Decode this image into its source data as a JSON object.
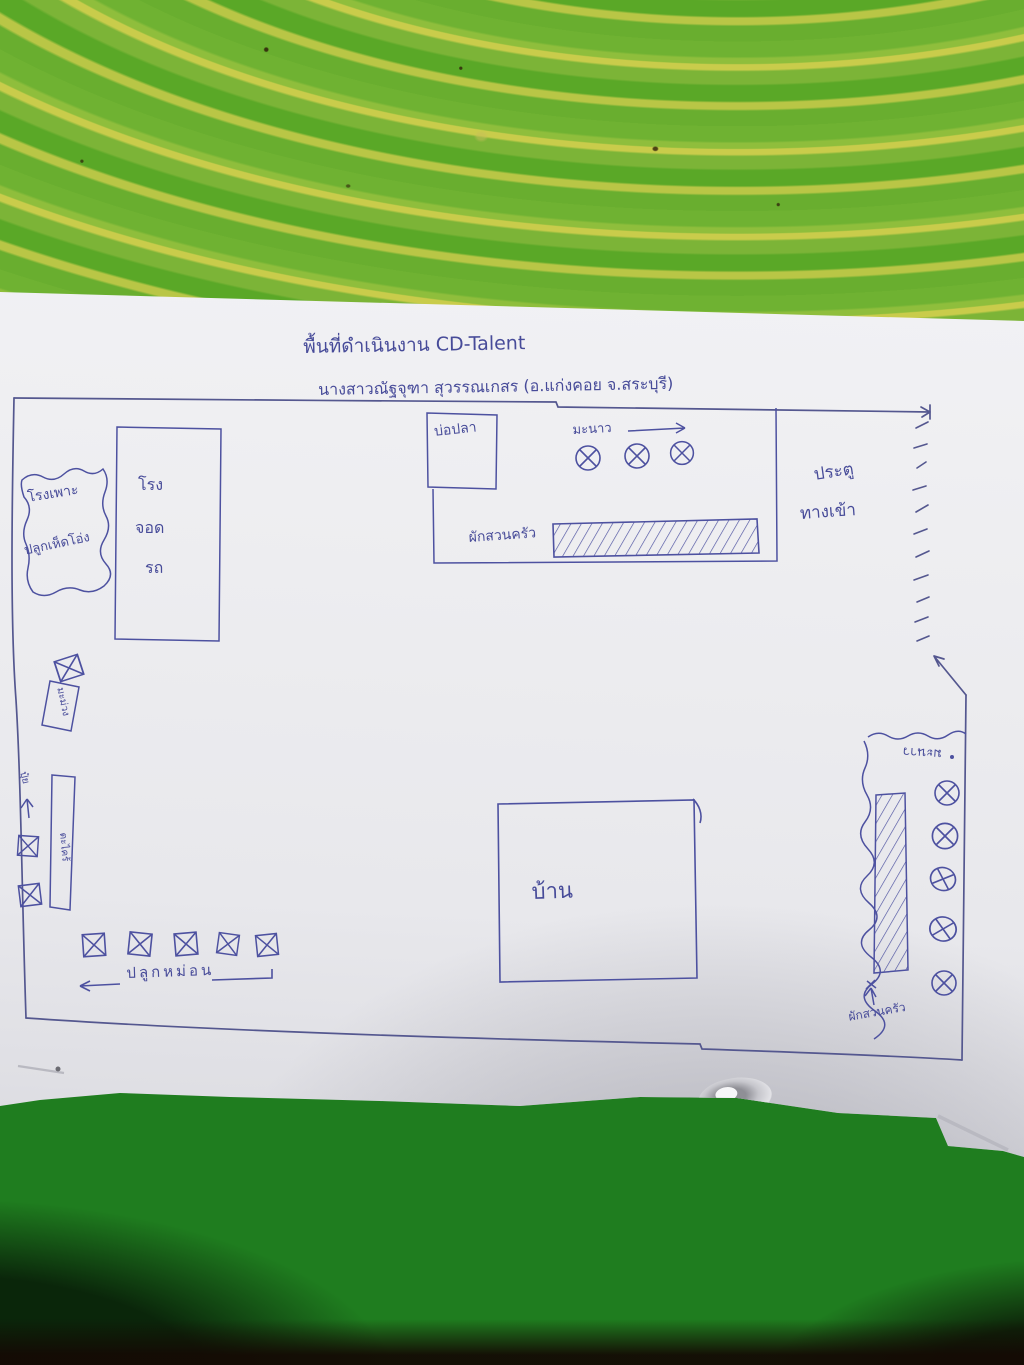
{
  "document": {
    "type": "hand-drawn site plan on paper",
    "program_name": "CD-Talent"
  },
  "title": {
    "line1": "พื้นที่ดำเนินงาน CD-Talent",
    "line2": "นางสาวณัฐจุฑา สุวรรณเกสร (อ.แก่งคอย จ.สระบุรี)"
  },
  "areas": {
    "mushroom_house": {
      "line1": "โรงเพาะ",
      "line2": "ปลูกเห็ดโอ่ง"
    },
    "garage": {
      "line1": "โรง",
      "line2": "จอด",
      "line3": "รถ"
    },
    "fish_pond": {
      "label": "บ่อปลา"
    },
    "lime_row_top": {
      "label": "มะนาว",
      "tree_count": 3
    },
    "vegetable_bed_top": {
      "label": "ผักสวนครัว"
    },
    "entrance_gate": {
      "line1": "ประตู",
      "line2": "ทางเข้า"
    },
    "tree_plot_small": {
      "label": "มะม่วง",
      "box_count": 1
    },
    "compost": {
      "label": "ปุ๋ย"
    },
    "lemongrass_bed": {
      "label": "ตะไคร้",
      "box_count": 2
    },
    "mulberry_row": {
      "label": "ปลูกหม่อน",
      "plant_count": 5
    },
    "house": {
      "label": "บ้าน"
    },
    "lime_row_right": {
      "label": "มะนาว",
      "tree_count": 5
    },
    "vegetable_bed_right": {
      "label": "ผักสวนครัว"
    }
  },
  "symbols": {
    "tree": "circle with X",
    "plant_box": "square with X"
  },
  "colors": {
    "ink": "#474b99",
    "paper": "#ececef",
    "table_top_green": "#69ae2f",
    "table_top_yellow": "#c9cc4b",
    "table_bottom_green": "#1f7d1f",
    "floor_dark": "#190e05"
  }
}
